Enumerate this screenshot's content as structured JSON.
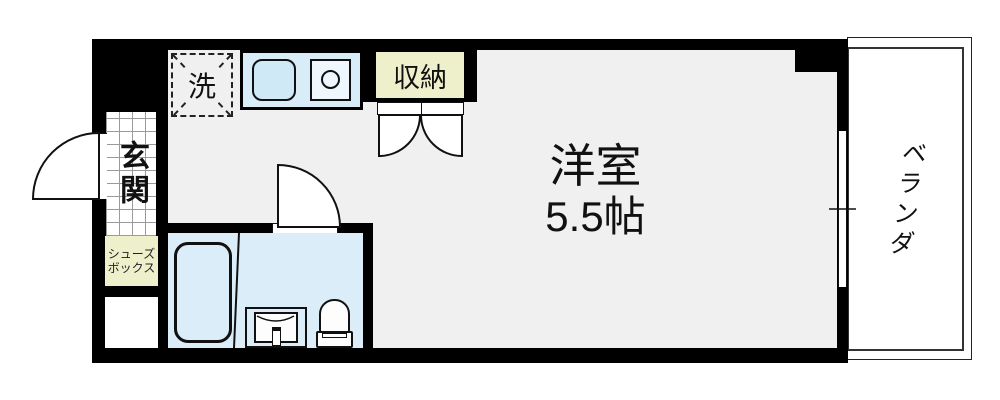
{
  "floorplan": {
    "main_room": {
      "name": "洋室",
      "size": "5.5帖"
    },
    "entrance": {
      "label": "玄関"
    },
    "shoe_box": {
      "label_lines": [
        "シューズ",
        "ボックス"
      ]
    },
    "laundry": {
      "label": "洗"
    },
    "storage": {
      "label": "収納"
    },
    "veranda": {
      "label": "ベランダ"
    },
    "colors": {
      "wall": "#000000",
      "floor": "#f0f0f0",
      "water_area": "#daedf8",
      "cabinet": "#eef0cc",
      "tile_line": "#9a9a9a",
      "outline": "#111111"
    }
  }
}
